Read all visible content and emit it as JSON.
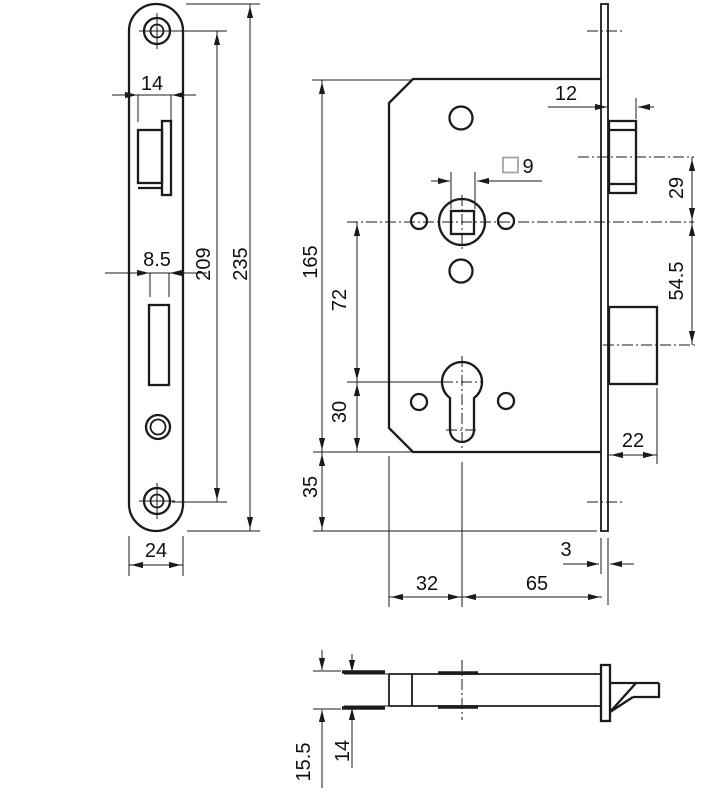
{
  "title": "Mortise lock dimensional drawing",
  "colors": {
    "line": "#1b1b1b",
    "square_symbol": "#a3a3a3",
    "background": "#ffffff"
  },
  "views": {
    "faceplate_front": {
      "dims": {
        "latch_opening_width": "14",
        "deadbolt_opening_width": "8.5",
        "screw_hole_spacing": "209",
        "plate_height": "235",
        "plate_width": "24"
      }
    },
    "case_front": {
      "dims": {
        "latch_projection": "12",
        "spindle_square_size": "9",
        "latch_to_spindle_centers": "29",
        "spindle_to_deadbolt_centers": "54.5",
        "case_height": "165",
        "spindle_to_cylinder_centers": "72",
        "cylinder_to_case_bottom": "30",
        "case_bottom_to_plate_end": "35",
        "deadbolt_projection": "22",
        "plate_thickness": "3",
        "case_behind_axis": "32",
        "backset": "65"
      }
    },
    "top_view": {
      "dims": {
        "overall_depth": "15.5",
        "case_depth": "14"
      }
    }
  }
}
